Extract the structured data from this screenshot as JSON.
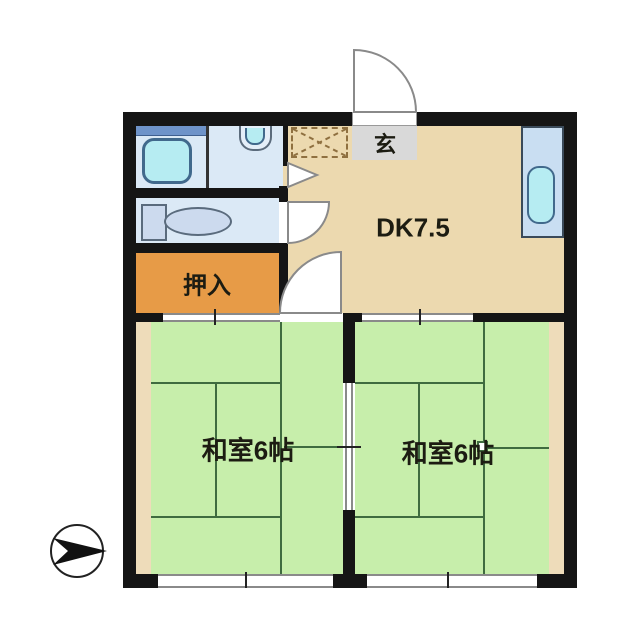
{
  "floorplan": {
    "title": "2DK apartment floor plan",
    "rooms": {
      "dk": {
        "label": "DK7.5",
        "floor_color": "#ecd9af"
      },
      "genkan": {
        "label": "玄",
        "floor_color": "#d9d9d9"
      },
      "closet": {
        "label": "押入",
        "floor_color": "#e79b47"
      },
      "washitsu_left": {
        "label": "和室6帖",
        "floor_color": "#c7eeab"
      },
      "washitsu_right": {
        "label": "和室6帖",
        "floor_color": "#c7eeab"
      },
      "bathroom": {
        "floor_color": "#dbe9f6"
      },
      "washroom": {
        "floor_color": "#dbe9f6"
      },
      "toilet_room": {
        "floor_color": "#dbe9f6"
      }
    },
    "colors": {
      "wall": "#151515",
      "tatami_line": "#3f6b3f",
      "fixture_cyan": "#b6ecf2",
      "counter_blue": "#c9def2",
      "toilet_fill": "#ccdaee",
      "edge_strip": "#eedcba",
      "door_symbol_gray": "#8a8a8a",
      "bath_shelf_blue": "#6e93c9"
    },
    "icons": {
      "bathtub": "bathtub-icon",
      "vanity_sink": "vanity-sink-icon",
      "toilet": "toilet-icon",
      "kitchen_sink": "kitchen-sink-icon",
      "shoe_cabinet": "shoe-cabinet-dashed-x-icon",
      "entrance_door": "swing-door-arc-icon",
      "toilet_door": "swing-door-arc-icon",
      "washitsu_door": "swing-door-arc-icon",
      "washroom_door": "folding-door-triangle-icon",
      "compass": "north-arrow-icon"
    }
  }
}
